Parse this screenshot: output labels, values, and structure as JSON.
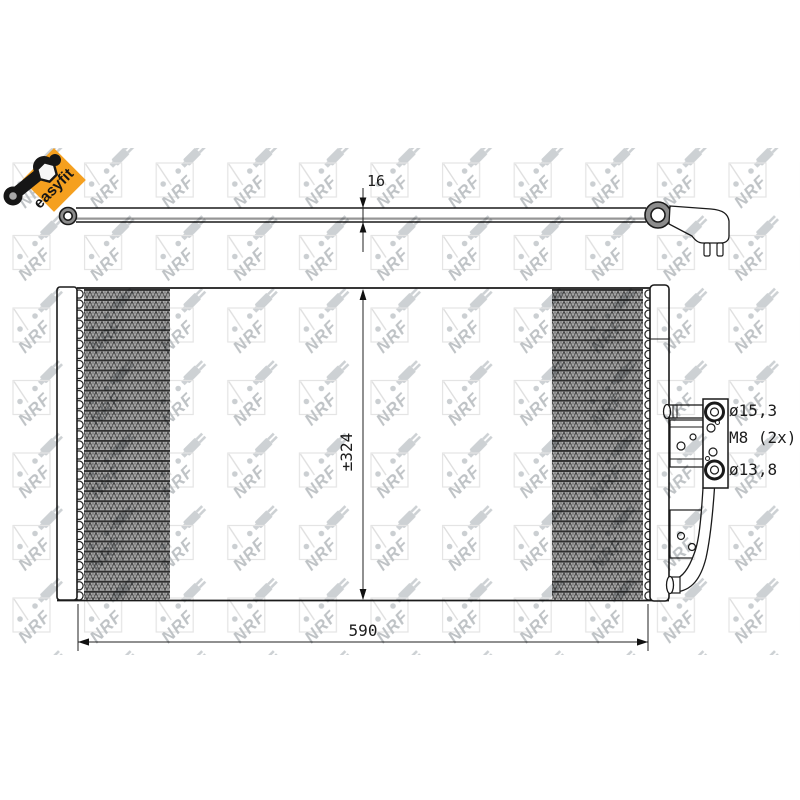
{
  "page": {
    "background_color": "#ffffff"
  },
  "logo": {
    "label": "easyfit",
    "badge_color": "#f5a01f",
    "tool_color": "#161616"
  },
  "watermark": {
    "text": "NRF",
    "tint": "#cbcfd2",
    "letter_color": "#bfc3c6"
  },
  "drawing": {
    "line_color": "#1a1a1a",
    "fin_color": "#a6a6a6",
    "dimensions": {
      "tube_thickness": "16",
      "core_height": "±324",
      "core_width": "590",
      "top_port": "ø15,3",
      "mount_bolts": "M8 (2x)",
      "bottom_port": "ø13,8"
    }
  }
}
